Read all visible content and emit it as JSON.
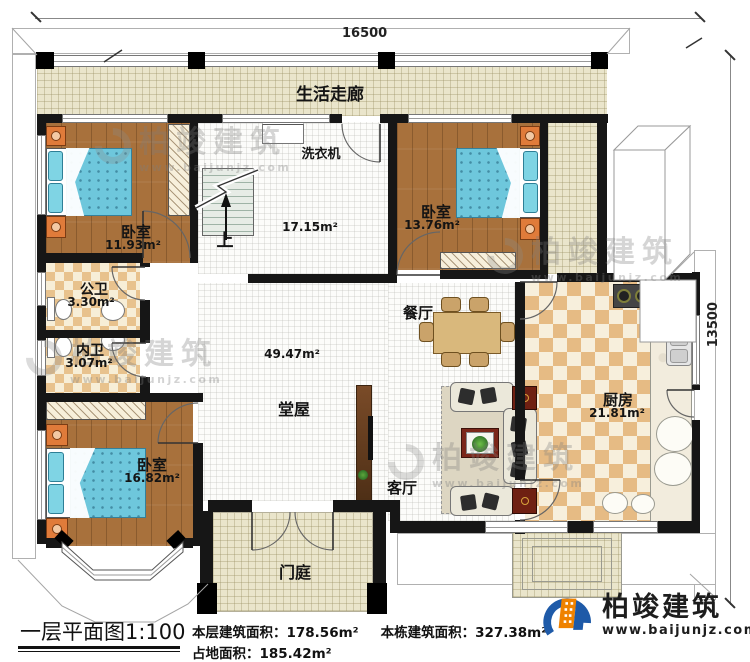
{
  "dimensions": {
    "top": "16500",
    "right": "13500"
  },
  "rooms": {
    "corridor": "生活走廊",
    "bedroom1": "卧室",
    "bedroom1_area": "11.93m²",
    "washer": "洗衣机",
    "stair_up": "上",
    "stairhall_area": "17.15m²",
    "bedroom2": "卧室",
    "bedroom2_area": "13.76m²",
    "bath_public": "公卫",
    "bath_public_area": "3.30m²",
    "bath_private": "内卫",
    "bath_private_area": "3.07m²",
    "dining": "餐厅",
    "hall": "堂屋",
    "hall_area": "49.47m²",
    "bedroom3": "卧室",
    "bedroom3_area": "16.82m²",
    "living": "客厅",
    "kitchen": "厨房",
    "kitchen_area": "21.81m²",
    "porch": "门庭"
  },
  "footer": {
    "title": "一层平面图1:100",
    "stat_floor": "本层建筑面积：178.56m²",
    "stat_building": "本栋建筑面积：327.38m²",
    "stat_land": "占地面积：185.42m²"
  },
  "brand": {
    "name": "柏竣建筑",
    "url": "www.baijunjz.com"
  },
  "watermark": {
    "name": "柏竣建筑",
    "url": "www.baijunjz.com"
  },
  "colors": {
    "accent_blue": "#1e5aa8",
    "accent_orange": "#ef8200",
    "wall": "#161616",
    "wood": "#a8713c",
    "mattress": "#6ec7dc"
  }
}
